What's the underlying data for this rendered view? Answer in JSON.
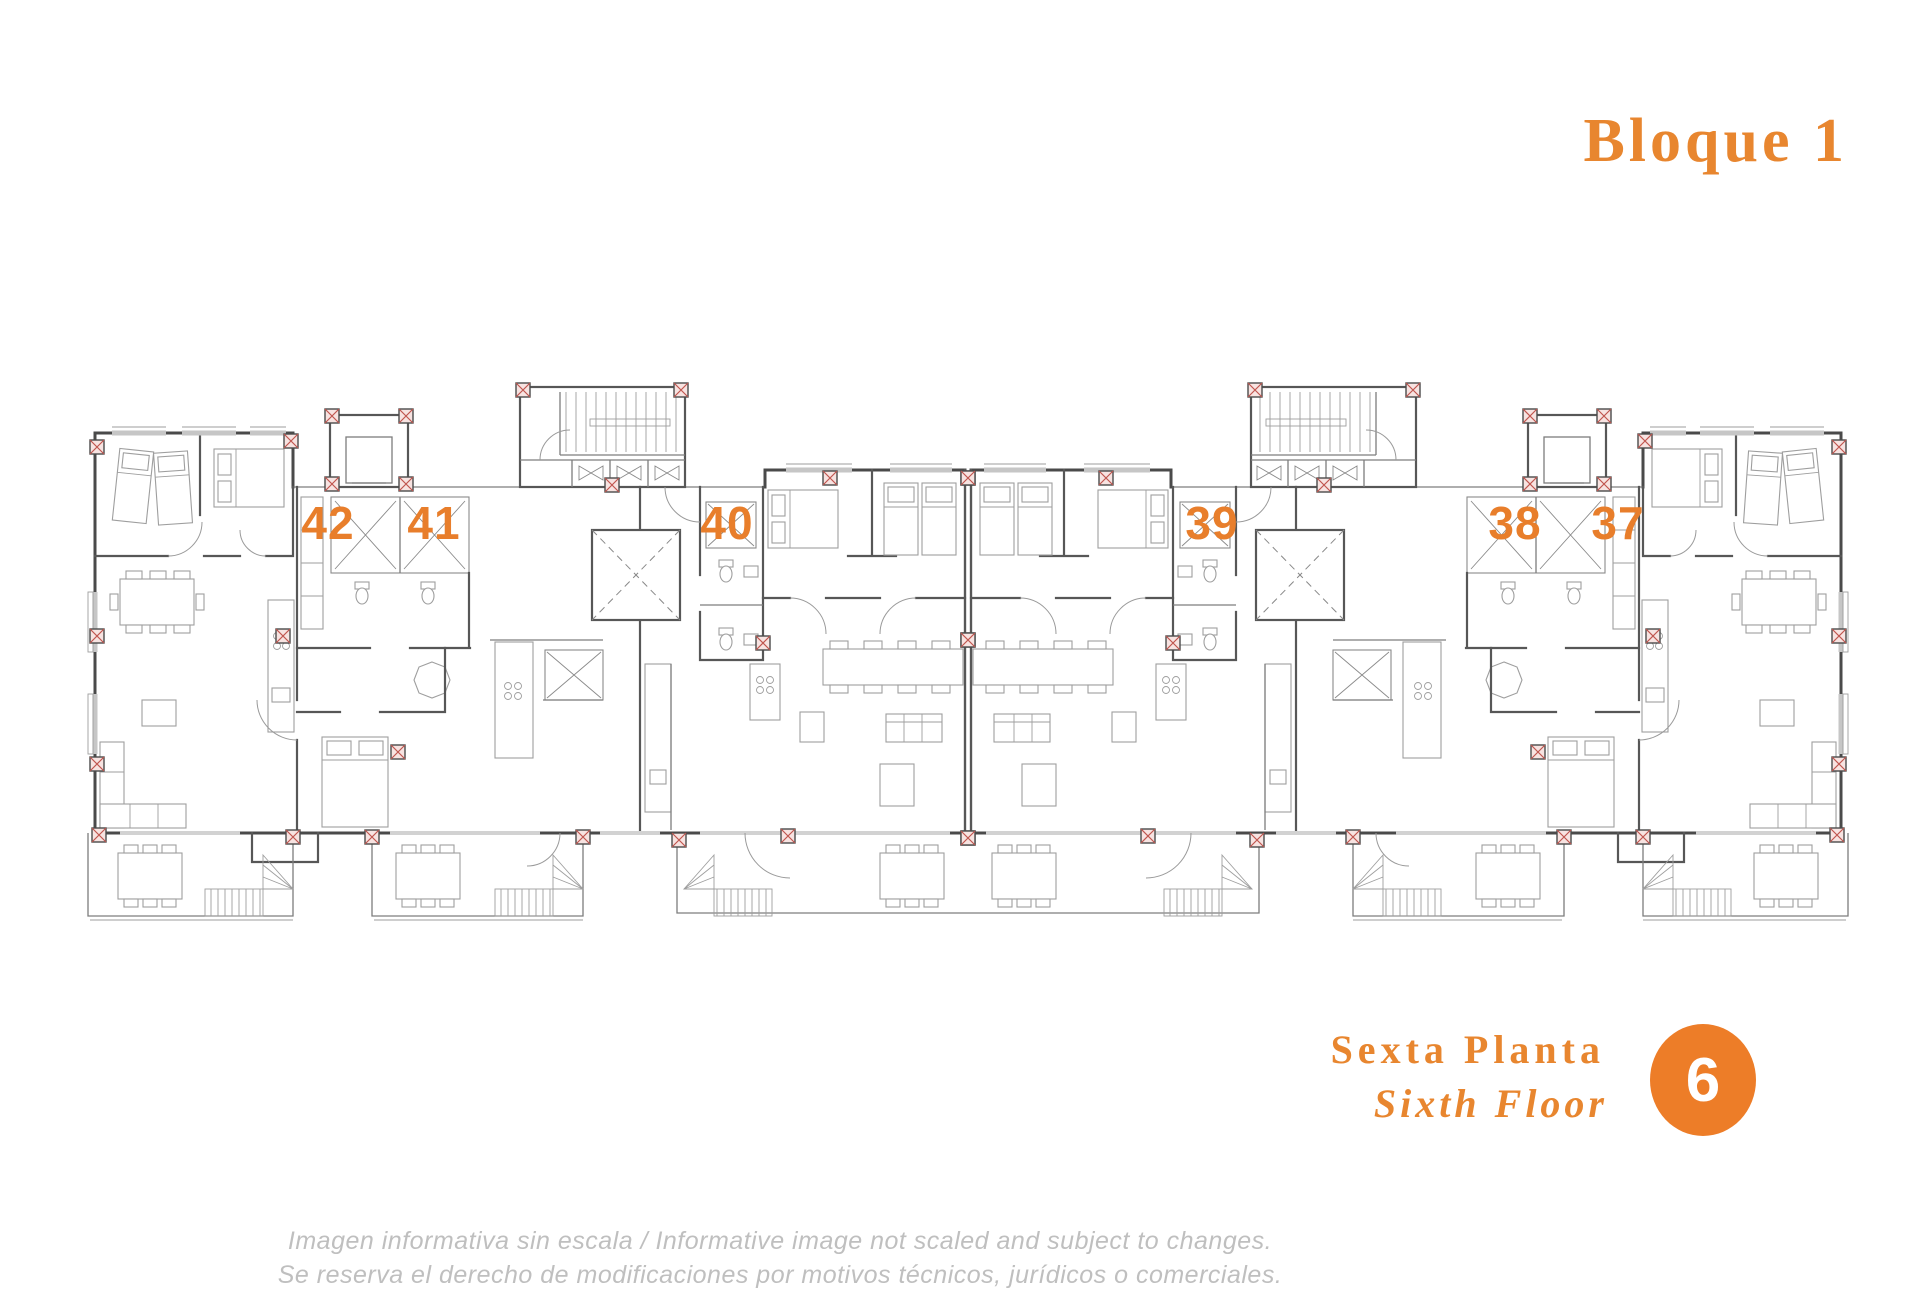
{
  "header": {
    "title": "Bloque 1"
  },
  "plan": {
    "type": "architectural-floor-plan",
    "units": [
      {
        "number": "42"
      },
      {
        "number": "41"
      },
      {
        "number": "40"
      },
      {
        "number": "39"
      },
      {
        "number": "38"
      },
      {
        "number": "37"
      }
    ]
  },
  "floor": {
    "spanish": "Sexta Planta",
    "english": "Sixth Floor",
    "badge": "6"
  },
  "disclaimer": {
    "line1": "Imagen informativa sin escala /  Informative image not scaled and subject to changes.",
    "line2": "Se reserva el derecho de modificaciones por motivos técnicos, jurídicos o comerciales."
  },
  "colors": {
    "accent_orange": "#E87E2B",
    "title_orange": "#E8862F",
    "badge_orange": "#ED7D28",
    "wall_gray": "#575757",
    "disclaimer_gray": "#BFBFBF",
    "column_marker_red": "#C0564F"
  }
}
